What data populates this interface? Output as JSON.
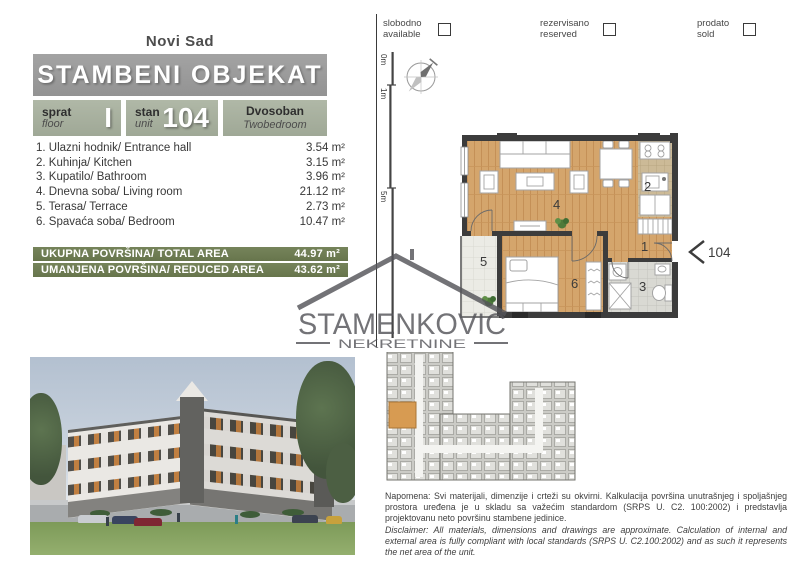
{
  "colors": {
    "header_bar_gray": "#9b9b9b",
    "info_cell_green": "#a9b1a0",
    "total_bar_green": "#6f7d53",
    "wood_floor": "#d4a56c",
    "wall_dark": "#3c3c3c",
    "highlighted_unit_orange": "#d79b52"
  },
  "header": {
    "city": "Novi Sad",
    "title": "STAMBENI OBJEKAT"
  },
  "legend": {
    "items": [
      {
        "sr": "slobodno",
        "en": "available"
      },
      {
        "sr": "rezervisano",
        "en": "reserved"
      },
      {
        "sr": "prodato",
        "en": "sold"
      }
    ]
  },
  "unit_info": {
    "floor": {
      "sr": "sprat",
      "en": "floor",
      "value": "I"
    },
    "unit": {
      "sr": "stan",
      "en": "unit",
      "value": "104"
    },
    "type": {
      "sr": "Dvosoban",
      "en": "Twobedroom"
    }
  },
  "rooms": [
    {
      "name": "1. Ulazni hodnik/ Entrance hall",
      "area": "3.54 m²"
    },
    {
      "name": "2. Kuhinja/ Kitchen",
      "area": "3.15 m²"
    },
    {
      "name": "3. Kupatilo/ Bathroom",
      "area": "3.96 m²"
    },
    {
      "name": "4. Dnevna soba/ Living room",
      "area": "21.12 m²"
    },
    {
      "name": "5. Terasa/ Terrace",
      "area": "2.73 m²"
    },
    {
      "name": "6. Spavaća soba/ Bedroom",
      "area": "10.47 m²"
    }
  ],
  "totals": [
    {
      "label": "UKUPNA POVRŠINA/ TOTAL AREA",
      "value": "44.97 m²"
    },
    {
      "label": "UMANJENA POVRŠINA/ REDUCED AREA",
      "value": "43.62 m²"
    }
  ],
  "floorplan": {
    "scale_labels": [
      "0m",
      "1m",
      "5m"
    ],
    "room_numbers": {
      "hall": "1",
      "kitchen": "2",
      "bathroom": "3",
      "living": "4",
      "terrace": "5",
      "bedroom": "6"
    },
    "unit_pointer": "104"
  },
  "watermark": {
    "name": "STAMENKOVIC",
    "subtitle": "NEKRETNINE"
  },
  "disclaimer": {
    "sr": "Napomena: Svi materijali, dimenzije i crteži su okvirni. Kalkulacija površina unutrašnjeg i spoljašnjeg prostora uređena je u skladu sa važećim standardom (SRPS U. C2. 100:2002) i predstavlja projektovanu neto površinu stambene jedinice.",
    "en": "Disclaimer: All materials, dimensions and drawings are approximate. Calculation of internal and external area is fully compliant with local standards (SRPS U. C2.100:2002) and as such it represents the net area of the unit."
  }
}
